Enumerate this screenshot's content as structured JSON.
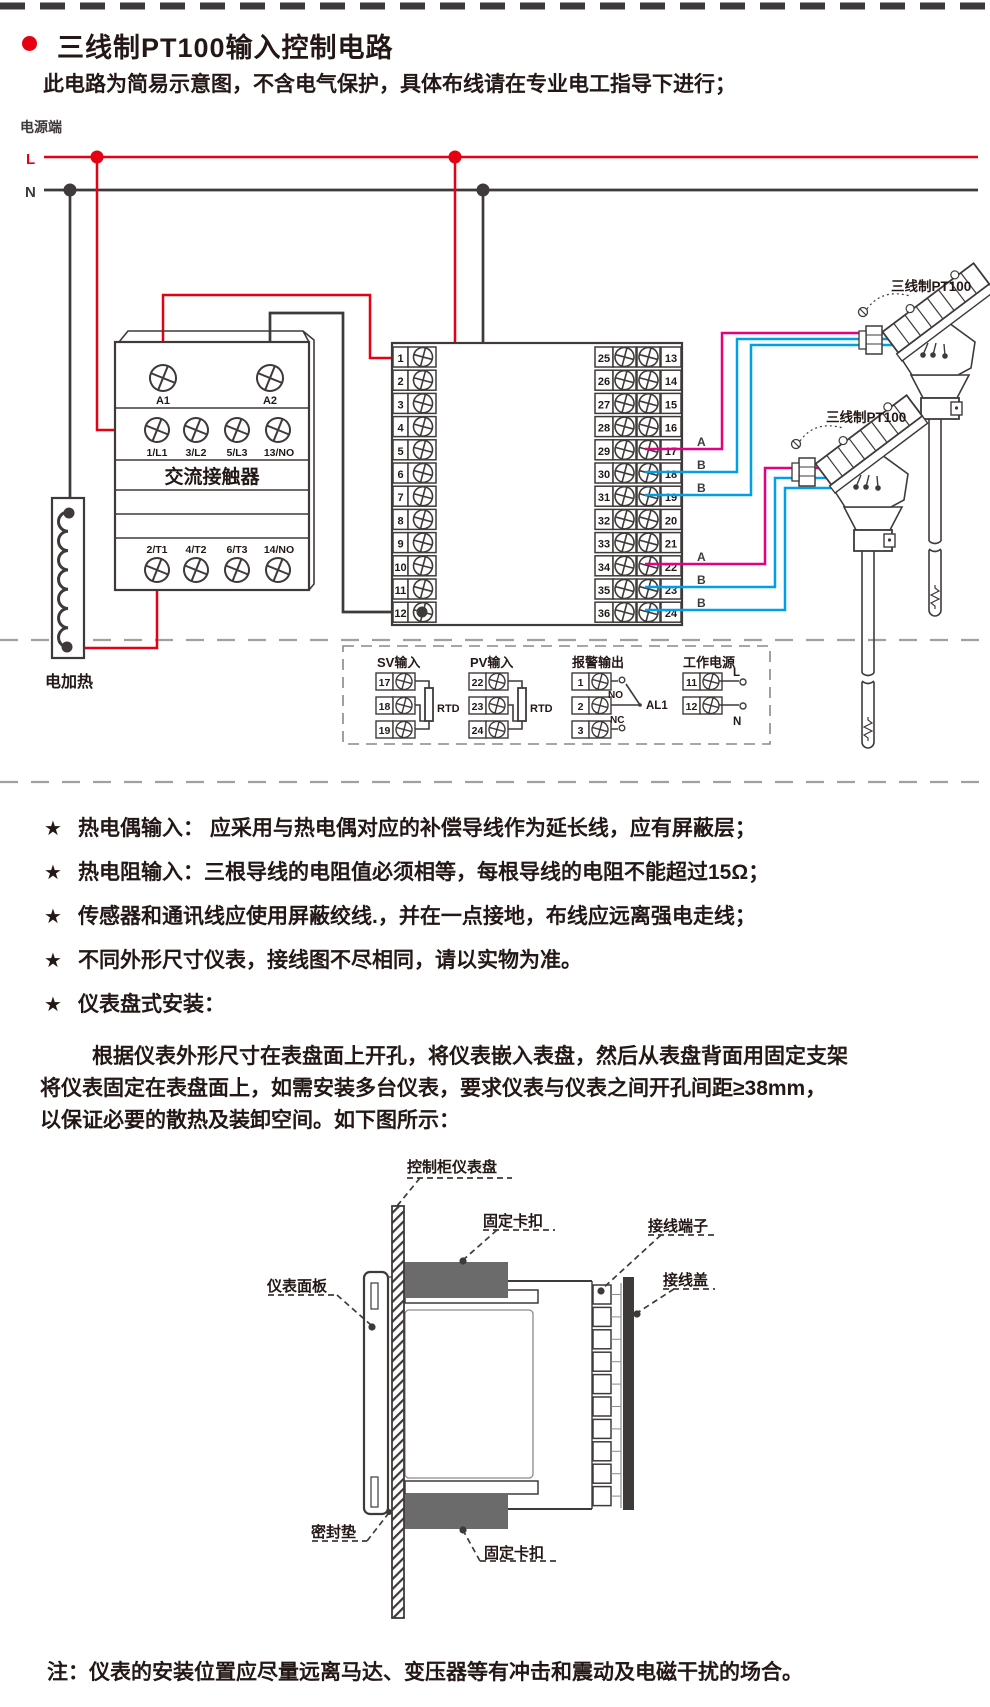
{
  "page": {
    "title": "三线制PT100输入控制电路",
    "subtitle": "此电路为简易示意图，不含电气保护，具体布线请在专业电工指导下进行；",
    "note": "注：仪表的安装位置应尽量远离马达、变压器等有冲击和震动及电磁干扰的场合。"
  },
  "colors": {
    "accent_red": "#e60012",
    "wire_pink": "#e5007f",
    "wire_blue": "#00a0e9",
    "ink": "#3e3a39",
    "dash_gray": "#9fa0a0",
    "clip_gray": "#6b6b6b"
  },
  "circuit": {
    "power_label": "电源端",
    "l_label": "L",
    "n_label": "N",
    "heater_label": "电加热",
    "contactor": {
      "name": "交流接触器",
      "coil_terminals": [
        "A1",
        "A2"
      ],
      "line_terminals": [
        "1/L1",
        "3/L2",
        "5/L3",
        "13/NO"
      ],
      "load_terminals": [
        "2/T1",
        "4/T2",
        "6/T3",
        "14/NO"
      ]
    },
    "left_strip": [
      "1",
      "2",
      "3",
      "4",
      "5",
      "6",
      "7",
      "8",
      "9",
      "10",
      "11",
      "12"
    ],
    "right_strip_left": [
      "25",
      "26",
      "27",
      "28",
      "29",
      "30",
      "31",
      "32",
      "33",
      "34",
      "35",
      "36"
    ],
    "right_strip_right": [
      "13",
      "14",
      "15",
      "16",
      "17",
      "18",
      "19",
      "20",
      "21",
      "22",
      "23",
      "24"
    ],
    "wire_labels_1": [
      "A",
      "B",
      "B"
    ],
    "wire_labels_2": [
      "A",
      "B",
      "B"
    ],
    "sensors": [
      {
        "label": "三线制PT100"
      },
      {
        "label": "三线制PT100"
      }
    ],
    "io": {
      "sv": {
        "title": "SV输入",
        "terminals": [
          "17",
          "18",
          "19"
        ],
        "component": "RTD"
      },
      "pv": {
        "title": "PV输入",
        "terminals": [
          "22",
          "23",
          "24"
        ],
        "component": "RTD"
      },
      "alarm": {
        "title": "报警输出",
        "terminals": [
          "1",
          "2",
          "3"
        ],
        "no": "NO",
        "nc": "NC",
        "name": "AL1"
      },
      "power": {
        "title": "工作电源",
        "terminals": [
          "11",
          "12"
        ],
        "l": "L",
        "n": "N"
      }
    }
  },
  "notes": [
    {
      "star": "★",
      "text": "热电偶输入： 应采用与热电偶对应的补偿导线作为延长线，应有屏蔽层；"
    },
    {
      "star": "★",
      "text": "热电阻输入：三根导线的电阻值必须相等，每根导线的电阻不能超过15Ω；"
    },
    {
      "star": "★",
      "text": "传感器和通讯线应使用屏蔽绞线.，并在一点接地，布线应远离强电走线；"
    },
    {
      "star": "★",
      "text": "不同外形尺寸仪表，接线图不尽相同，请以实物为准。"
    },
    {
      "star": "★",
      "text": "仪表盘式安装："
    }
  ],
  "install": {
    "paragraph": [
      "根据仪表外形尺寸在表盘面上开孔，将仪表嵌入表盘，然后从表盘背面用固定支架",
      "将仪表固定在表盘面上，如需安装多台仪表，要求仪表与仪表之间开孔间距≥38mm，",
      "以保证必要的散热及装卸空间。如下图所示："
    ],
    "labels": {
      "panel": "控制柜仪表盘",
      "clip_top": "固定卡扣",
      "terminal": "接线端子",
      "cover": "接线盖",
      "front": "仪表面板",
      "gasket": "密封垫",
      "clip_bottom": "固定卡扣"
    }
  }
}
